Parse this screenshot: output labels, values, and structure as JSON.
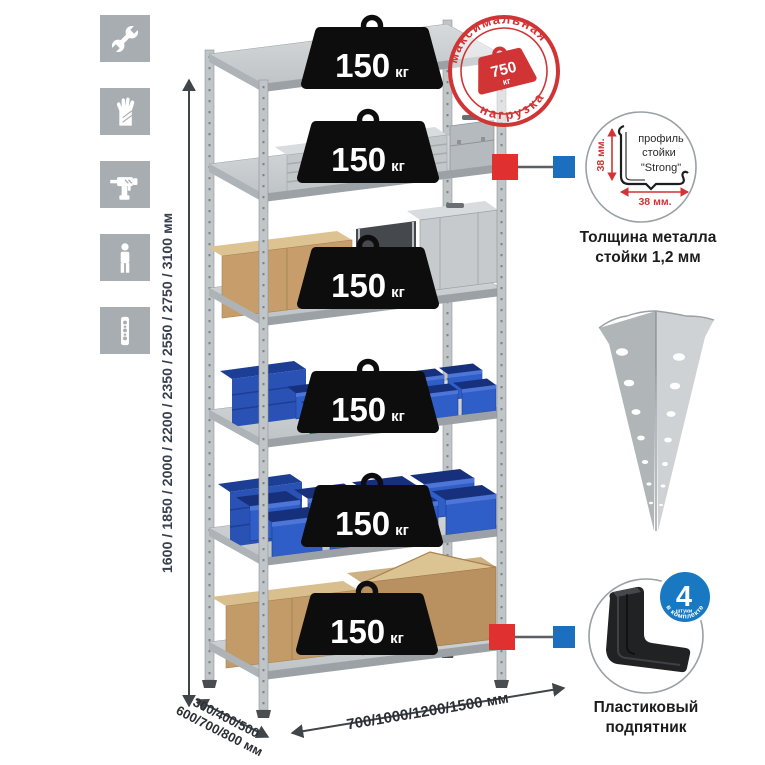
{
  "sidebar": {
    "icons": [
      {
        "name": "wrench"
      },
      {
        "name": "gloves"
      },
      {
        "name": "drill"
      },
      {
        "name": "person"
      },
      {
        "name": "perforated-post"
      }
    ]
  },
  "rack": {
    "shelf_count": 6,
    "load_value": "150",
    "load_unit": "кг"
  },
  "max_load_stamp": {
    "arc_top": "максимальная",
    "arc_bottom": "нагрузка",
    "value": "750",
    "unit": "кг"
  },
  "dimensions": {
    "height_label": "1600 / 1850 / 2000 / 2200 / 2350 / 2550 / 2750 / 3100 мм",
    "depth_label_line1": "300/400/500",
    "depth_label_line2": "600/700/800 мм",
    "width_label": "700/1000/1200/1500 мм"
  },
  "profile_detail": {
    "drawing_label_line1": "профиль",
    "drawing_label_line2": "стойки",
    "drawing_label_line3": "\"Strong\"",
    "dim_vertical": "38 мм.",
    "dim_horizontal": "38 мм.",
    "caption_line1": "Толщина металла",
    "caption_line2": "стойки 1,2 мм"
  },
  "foot_detail": {
    "badge_value": "4",
    "badge_unit": "штуки",
    "badge_arc": "в комплекте",
    "caption_line1": "Пластиковый",
    "caption_line2": "подпятник"
  },
  "colors": {
    "stamp_red": "#d13434",
    "marker_red": "#e03030",
    "marker_blue": "#1c6fbe",
    "badge_blue": "#1878c2",
    "bin_blue": "#2f5ec9"
  }
}
